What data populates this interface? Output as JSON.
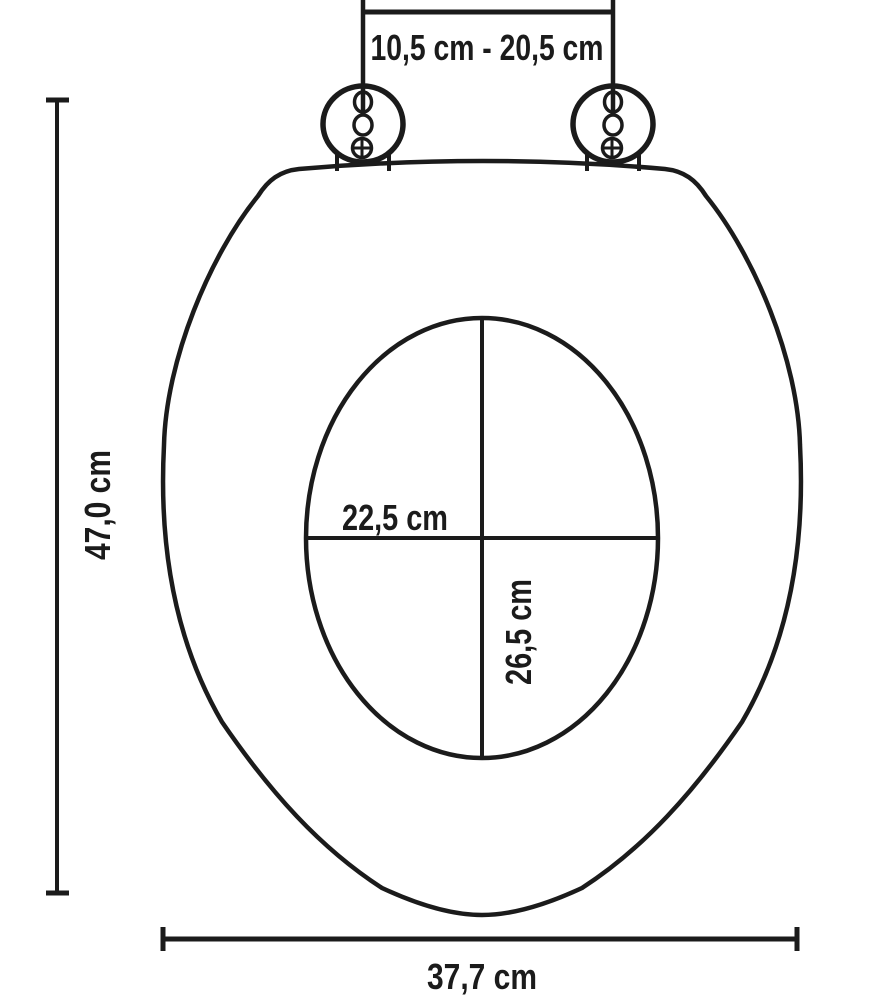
{
  "diagram": {
    "colors": {
      "line": "#1b1b1b",
      "background": "#ffffff"
    },
    "dimensions": {
      "hinge_distance": {
        "label": "10,5 cm - 20,5 cm"
      },
      "total_length": {
        "label": "47,0 cm"
      },
      "inner_width": {
        "label": "22,5 cm"
      },
      "inner_depth": {
        "label": "26,5 cm"
      },
      "total_width": {
        "label": "37,7 cm"
      }
    }
  }
}
